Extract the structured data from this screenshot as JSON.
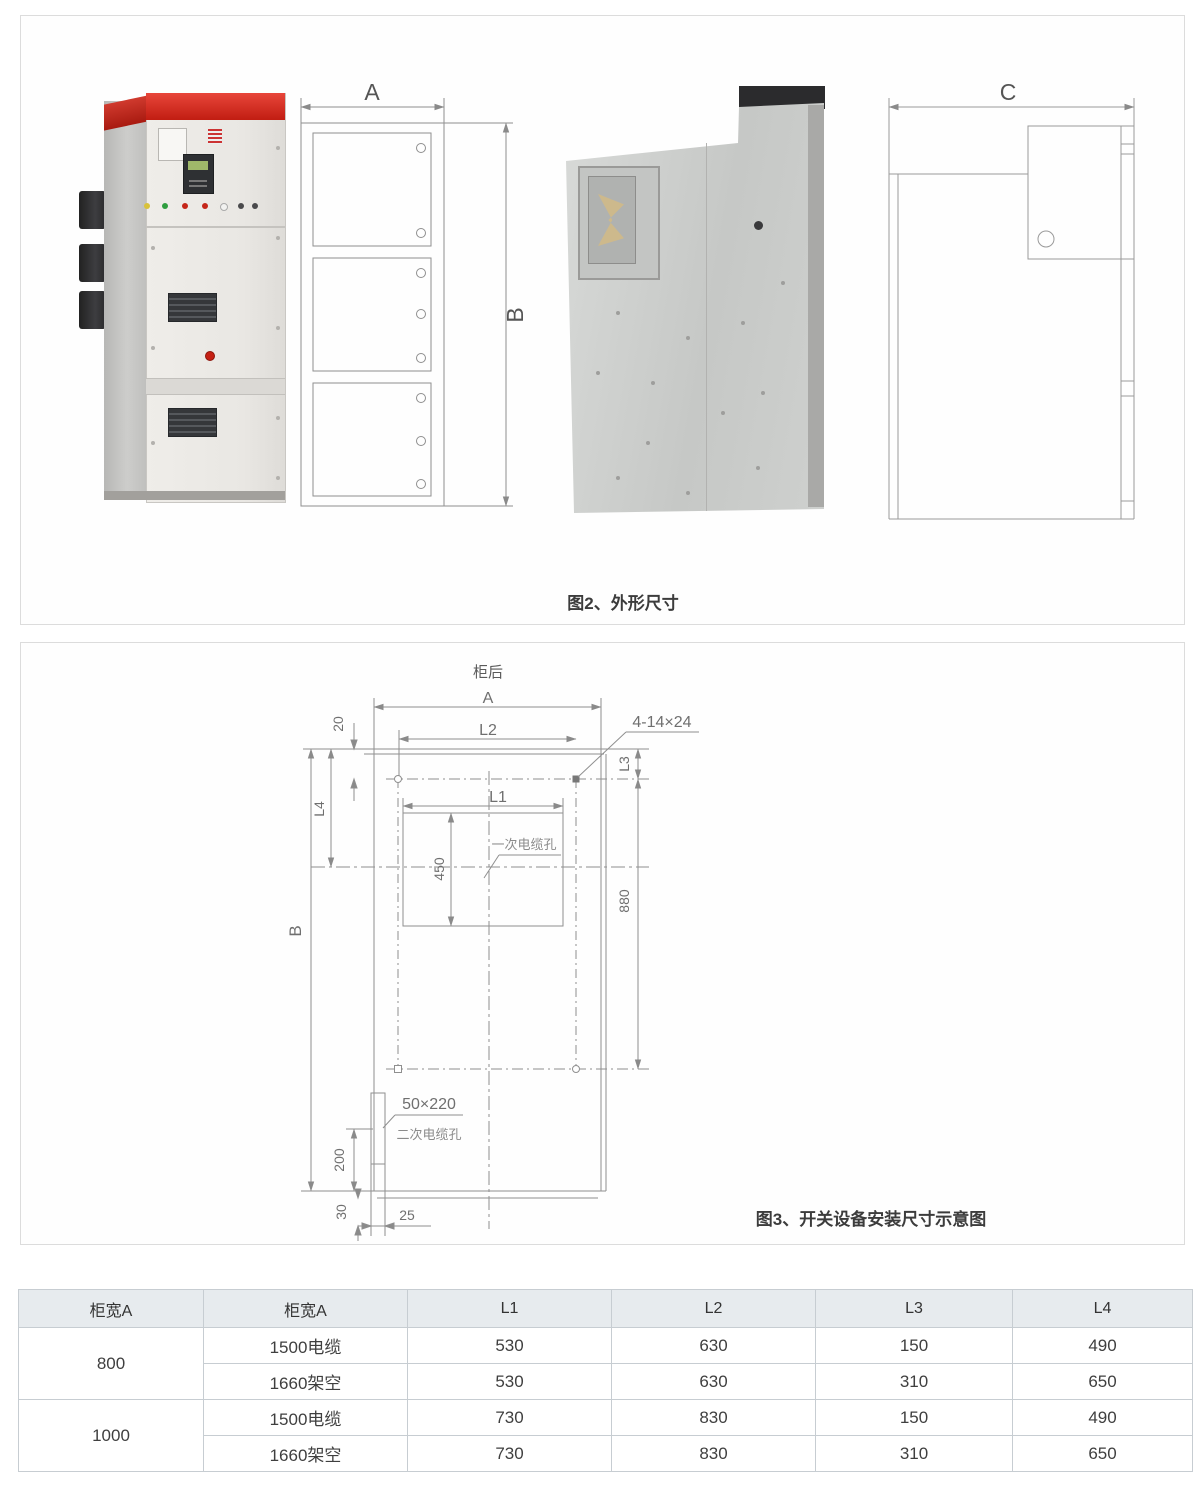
{
  "fig2": {
    "caption": "图2、外形尺寸",
    "dim_a": "A",
    "dim_b": "B",
    "dim_c": "C"
  },
  "fig3": {
    "caption": "图3、开关设备安装尺寸示意图",
    "rear_label": "柜后",
    "dim_a": "A",
    "dim_b": "B",
    "dim_l1": "L1",
    "dim_l2": "L2",
    "dim_l3": "L3",
    "dim_l4": "L4",
    "dim_20": "20",
    "dim_450": "450",
    "dim_880": "880",
    "dim_200": "200",
    "dim_30": "30",
    "dim_25": "25",
    "bolt_holes": "4-14×24",
    "primary_cable_hole": "一次电缆孔",
    "secondary_hole_size": "50×220",
    "secondary_cable_hole": "二次电缆孔"
  },
  "table": {
    "headers": [
      "柜宽A",
      "柜宽A",
      "L1",
      "L2",
      "L3",
      "L4"
    ],
    "groups": [
      {
        "width": "800",
        "rows": [
          {
            "type": "1500电缆",
            "values": [
              "530",
              "630",
              "150",
              "490"
            ]
          },
          {
            "type": "1660架空",
            "values": [
              "530",
              "630",
              "310",
              "650"
            ]
          }
        ]
      },
      {
        "width": "1000",
        "rows": [
          {
            "type": "1500电缆",
            "values": [
              "730",
              "830",
              "150",
              "490"
            ]
          },
          {
            "type": "1660架空",
            "values": [
              "730",
              "830",
              "310",
              "650"
            ]
          }
        ]
      }
    ]
  },
  "colors": {
    "accent_red": "#d6271c",
    "table_header_bg": "#e7ebee",
    "drawing_line": "#8f8f8f"
  }
}
